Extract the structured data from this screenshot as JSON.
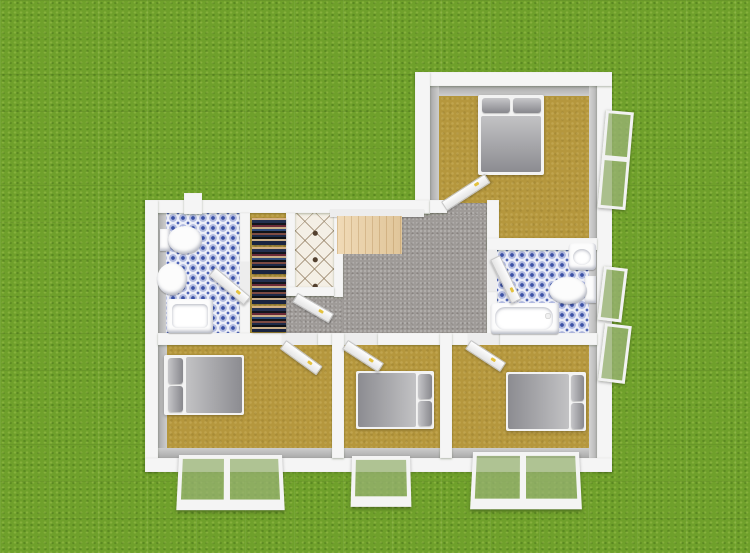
{
  "scene": {
    "type": "3d-floor-plan-render",
    "view": "overhead exterior view of a single-story L-shaped house",
    "background": "grass lawn",
    "visible_text": "none"
  },
  "palette": {
    "grass_green": "#6fa02b",
    "wall_white": "#f5f5f5",
    "wall_inner_face_gray": "#a9a9a9",
    "bedroom_floor_gold": "#b5973d",
    "living_carpet_gray": "#9f9b98",
    "bathroom_tile_blue": "#3b51a5",
    "bathroom_tile_base": "#eceef7",
    "hall_tile_cream": "#f4efe5",
    "hall_tile_dot_brown": "#53402f",
    "wood_rug": "#ecd0a2",
    "bedding_gray": "#9a9a9e",
    "fixture_white": "#fcfcfc",
    "window_glass_green": "#97b272",
    "door_handle_gold": "#e4c23e"
  },
  "rooms": [
    {
      "name": "bedroom-top",
      "floor": "gold-carpet",
      "furniture": [
        "double-bed"
      ]
    },
    {
      "name": "bathroom-left",
      "floor": "blue-mosaic-tile",
      "furniture": [
        "toilet",
        "pedestal-sink",
        "shower-tub"
      ]
    },
    {
      "name": "closet-hallway",
      "floor": "gold-carpet",
      "furniture": [
        "clothes-stack-1",
        "clothes-stack-2",
        "clothes-stack-3",
        "clothes-stack-4"
      ]
    },
    {
      "name": "entry-hall",
      "floor": "cream-diamond-tile",
      "furniture": []
    },
    {
      "name": "living-room",
      "floor": "gray-carpet",
      "furniture": [
        "wood-area-rug",
        "window-ledge"
      ]
    },
    {
      "name": "bathroom-right",
      "floor": "blue-mosaic-tile",
      "furniture": [
        "washbasin",
        "toilet",
        "bathtub"
      ]
    },
    {
      "name": "bedroom-bottom-left",
      "floor": "gold-carpet",
      "furniture": [
        "double-bed"
      ]
    },
    {
      "name": "bedroom-bottom-middle",
      "floor": "gold-carpet",
      "furniture": [
        "double-bed"
      ]
    },
    {
      "name": "bedroom-bottom-right",
      "floor": "gold-carpet",
      "furniture": [
        "double-bed"
      ]
    }
  ],
  "doors": [
    {
      "name": "bedroom-top-door",
      "state": "open"
    },
    {
      "name": "bathroom-left-door",
      "state": "open"
    },
    {
      "name": "entry-hall-door",
      "state": "open"
    },
    {
      "name": "bedroom-bottom-left-door",
      "state": "open"
    },
    {
      "name": "bedroom-bottom-middle-door",
      "state": "open"
    },
    {
      "name": "bedroom-bottom-right-door",
      "state": "open"
    },
    {
      "name": "bathroom-right-door",
      "state": "open"
    }
  ],
  "windows": [
    {
      "name": "bedroom-top-east-window",
      "panes": 2,
      "state": "open"
    },
    {
      "name": "bathroom-right-east-window",
      "panes": 1,
      "state": "open"
    },
    {
      "name": "bedroom-bottom-right-east-window",
      "panes": 1,
      "state": "open"
    },
    {
      "name": "bedroom-bottom-left-south-window",
      "panes": 2,
      "state": "open"
    },
    {
      "name": "bedroom-bottom-middle-south-window",
      "panes": 1,
      "state": "open"
    },
    {
      "name": "bedroom-bottom-right-south-window",
      "panes": 2,
      "state": "open"
    }
  ]
}
